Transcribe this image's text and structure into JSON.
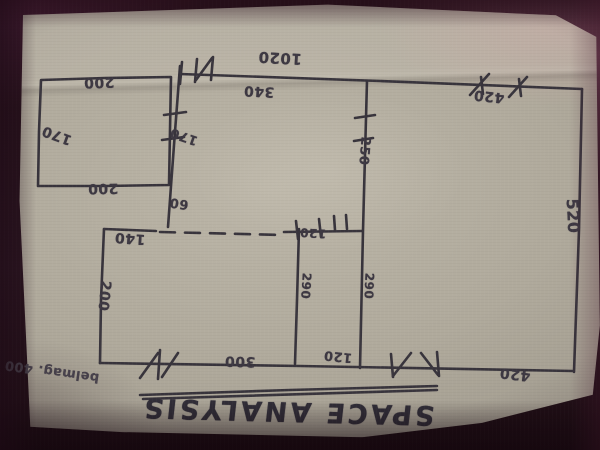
{
  "title": "SPACE ANALYSIS",
  "note": "belmag. 400",
  "dims": {
    "overall_top": "1020",
    "left_room_top": "200",
    "left_room_side": "170",
    "left_room_bottom": "200",
    "top_mid_segment": "340",
    "top_right_segment": "420",
    "mid_wall_upper": "170",
    "mid_wall_stub": "60",
    "inner_wall_upper": "250",
    "right_side": "520",
    "bottom_left_room_width": "140",
    "bottom_left_room_side": "200",
    "bottom_left_room_bottom": "300",
    "mid_room_left_wall": "290",
    "mid_room_right_wall": "290",
    "mid_room_opening": "120",
    "mid_room_bottom": "120",
    "bottom_right_segment": "420"
  }
}
